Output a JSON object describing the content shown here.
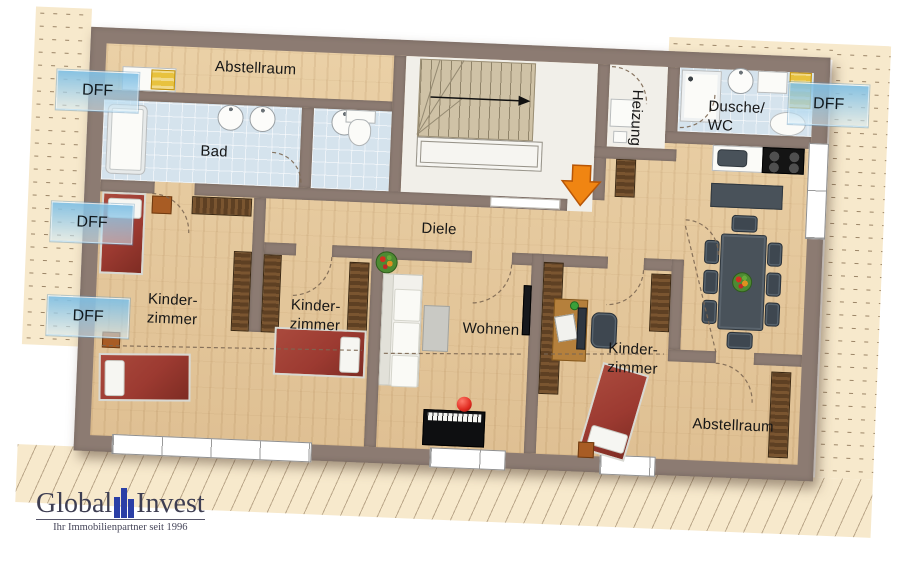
{
  "rooms": {
    "abstellraum_top": {
      "label": "Abstellraum"
    },
    "bad": {
      "label": "Bad"
    },
    "diele": {
      "label": "Diele"
    },
    "heizung": {
      "label": "Heizung"
    },
    "dusche_wc": {
      "label_line1": "Dusche/",
      "label_line2": "WC"
    },
    "kinderzimmer_left": {
      "label_line1": "Kinder-",
      "label_line2": "zimmer"
    },
    "kinderzimmer_middle": {
      "label_line1": "Kinder-",
      "label_line2": "zimmer"
    },
    "wohnen": {
      "label": "Wohnen"
    },
    "kinderzimmer_right": {
      "label_line1": "Kinder-",
      "label_line2": "zimmer"
    },
    "abstellraum_bottom": {
      "label": "Abstellraum"
    }
  },
  "roof_windows": {
    "left_top": "DFF",
    "left_middle": "DFF",
    "left_bottom": "DFF",
    "right": "DFF"
  },
  "logo": {
    "brand_part1": "Global",
    "brand_part2": "Invest",
    "tagline": "Ihr Immobilienpartner seit 1996"
  },
  "colors": {
    "wall": "#8c7b72",
    "wood": "#ead0a6",
    "wood_deep": "#dfc093",
    "tile": "#d5e3ed",
    "floor_light": "#f1efe9",
    "roof": "#f7e9cc",
    "dff_blue": "#7fbfe4",
    "bed_red": "#9c3a31",
    "furn_brown": "#5e4023",
    "furn_brown_light": "#7a5530",
    "slate": "#49525a",
    "orange": "#f08512",
    "logo_blue": "#2b3fa6",
    "logo_text": "#3e3e52",
    "label": "#161616"
  }
}
